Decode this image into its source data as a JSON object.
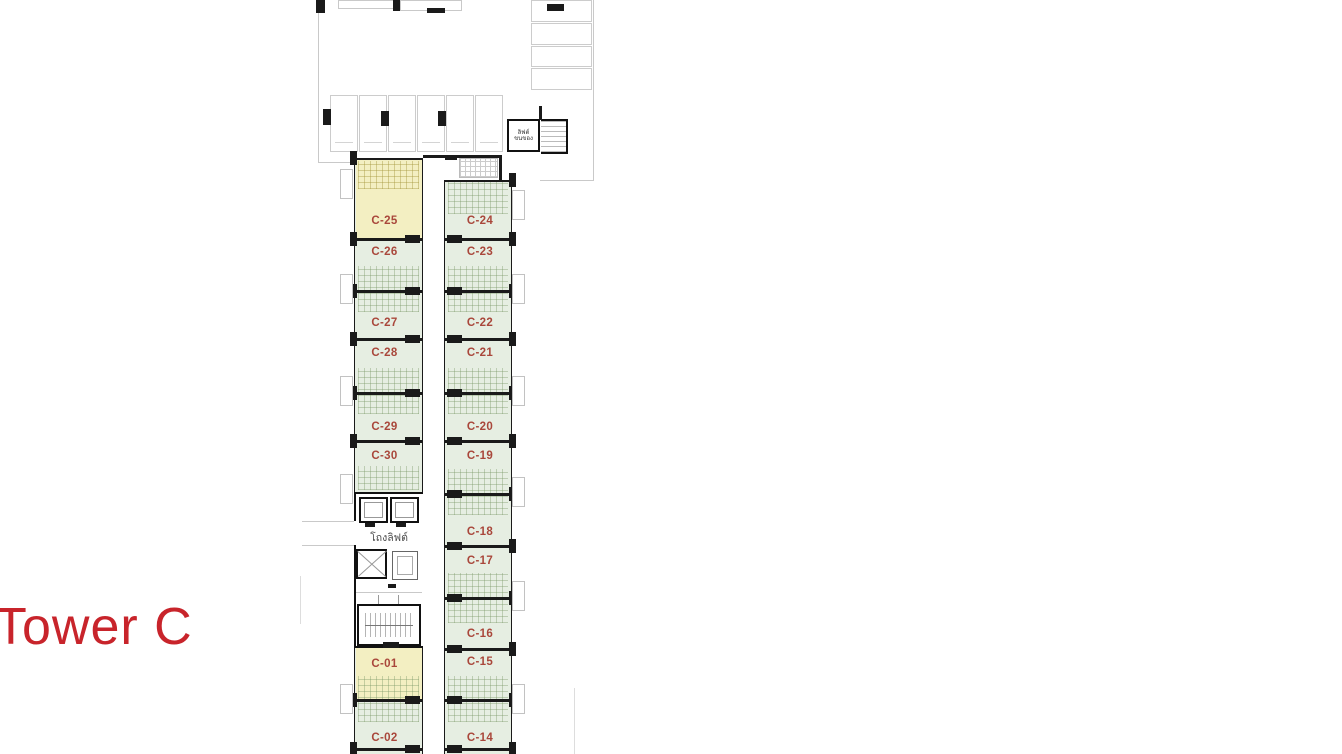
{
  "title": {
    "text": "Tower C"
  },
  "colors": {
    "accent_red": "#c8242b",
    "unit_label": "#a9473b",
    "green_fill": "#e6eee2",
    "yellow_fill": "#f3efc2",
    "wall": "#1a1a1a",
    "gray_line": "#c9c9c9"
  },
  "labels": {
    "elevator_hall": "โถงลิฟต์",
    "service_lift_line1": "ลิฟต์",
    "service_lift_line2": "ขนของ"
  },
  "plan": {
    "columns": {
      "left": {
        "x": 354,
        "width": 69,
        "top": 158,
        "units": [
          {
            "label": "C-25",
            "label_top": 215,
            "highlight": true
          },
          {
            "label": "C-26",
            "label_top": 246
          },
          {
            "label": "C-27",
            "label_top": 317
          },
          {
            "label": "C-28",
            "label_top": 347
          },
          {
            "label": "C-29",
            "label_top": 421
          },
          {
            "label": "C-30",
            "label_top": 450
          },
          {
            "label": "C-01",
            "label_top": 658,
            "highlight": true
          },
          {
            "label": "C-02",
            "label_top": 732
          }
        ],
        "walls": [
          238,
          290,
          338,
          392,
          440,
          699,
          748
        ],
        "bath_zones": [
          [
            161,
            28,
            "yellowish"
          ],
          [
            266,
            46
          ],
          [
            368,
            46
          ],
          [
            466,
            24
          ],
          [
            676,
            46
          ]
        ],
        "yellow_zones": [
          [
            160,
            78
          ],
          [
            648,
            51
          ]
        ]
      },
      "right": {
        "x": 444,
        "width": 68,
        "top": 180,
        "units": [
          {
            "label": "C-24",
            "label_top": 215
          },
          {
            "label": "C-23",
            "label_top": 246
          },
          {
            "label": "C-22",
            "label_top": 317
          },
          {
            "label": "C-21",
            "label_top": 347
          },
          {
            "label": "C-20",
            "label_top": 421
          },
          {
            "label": "C-19",
            "label_top": 450
          },
          {
            "label": "C-18",
            "label_top": 526
          },
          {
            "label": "C-17",
            "label_top": 555
          },
          {
            "label": "C-16",
            "label_top": 628
          },
          {
            "label": "C-15",
            "label_top": 656
          },
          {
            "label": "C-14",
            "label_top": 732
          }
        ],
        "walls": [
          238,
          290,
          338,
          392,
          440,
          493,
          545,
          597,
          648,
          699,
          748
        ],
        "bath_zones": [
          [
            182,
            32
          ],
          [
            266,
            46
          ],
          [
            368,
            46
          ],
          [
            469,
            46
          ],
          [
            573,
            50
          ],
          [
            676,
            46
          ]
        ],
        "yellow_zones": []
      }
    },
    "parking": {
      "stall_row_count": 6,
      "stall_col_count": 4
    }
  }
}
